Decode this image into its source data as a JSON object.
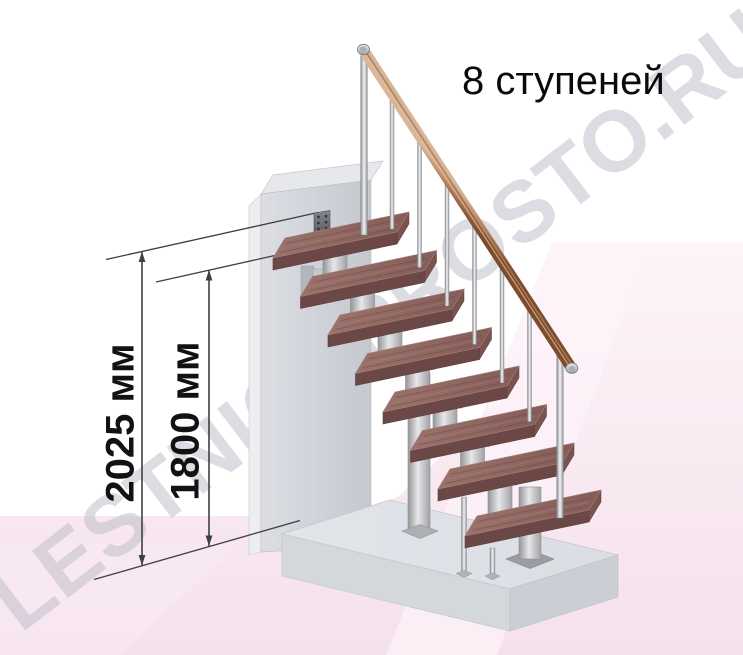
{
  "title": "8 ступеней",
  "dimension_labels": [
    "2025 мм",
    "1800 мм"
  ],
  "watermark": "LESTNICAPROSTO.RU",
  "stairs": {
    "step_count": 8
  },
  "colors": {
    "background": "#ffffff",
    "floor_pink": "#f5e1eb",
    "floor_pink_light": "#fdf4f9",
    "dim_line": "#3f4044",
    "text": "#0a0a0a",
    "tread_top_light": "#9b736c",
    "tread_top_dark": "#855c57",
    "tread_front": "#6b4845",
    "tread_side": "#7a534f",
    "metal_light": "#e7e7e9",
    "metal_dark": "#96969a",
    "wall_light": "#dcdee4",
    "wall_dark": "#c5c8ce",
    "slab_top": "#e2e5ea",
    "slab_front_left": "#d4d7dc",
    "slab_front_right": "#cbcfd5",
    "rail_wood_light": "#d9b698",
    "rail_wood_mid": "#b07c58",
    "rail_wood_dark": "#7d4c2c"
  }
}
